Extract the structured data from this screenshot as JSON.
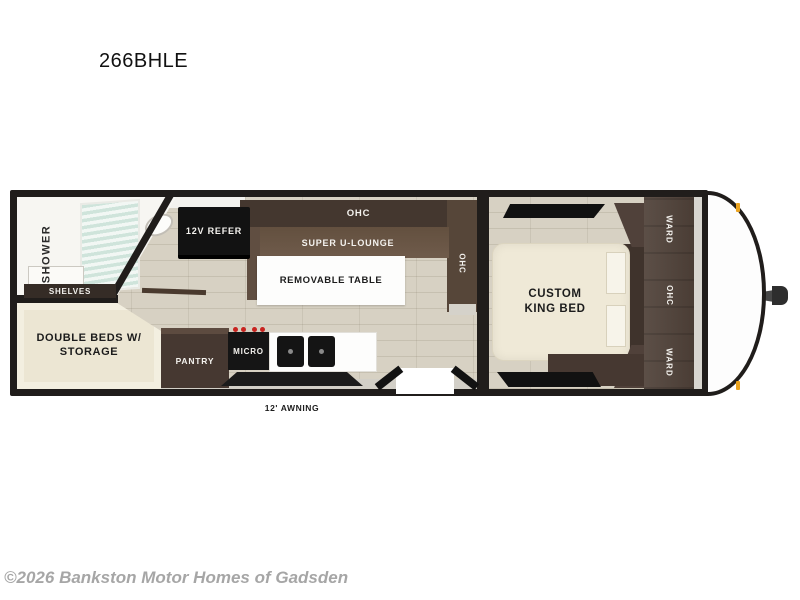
{
  "title": "266BHLE",
  "floorplan": {
    "awning": "12' AWNING",
    "bathroom": {
      "shower": "SHOWER",
      "shelves": "SHELVES"
    },
    "galley": {
      "refer": "12V REFER",
      "pantry": "PANTRY",
      "micro": "MICRO"
    },
    "living": {
      "ohc_top": "OHC",
      "lounge": "SUPER U-LOUNGE",
      "table": "REMOVABLE TABLE",
      "ohc_side": "OHC"
    },
    "bunks": {
      "line1": "DOUBLE BEDS W/",
      "line2": "STORAGE"
    },
    "bedroom": {
      "bed_line1": "CUSTOM",
      "bed_line2": "KING BED",
      "ward_top": "WARD",
      "ohc": "OHC",
      "ward_bottom": "WARD"
    }
  },
  "footer": {
    "copyright": "©2026 Bankston Motor Homes of Gadsden"
  },
  "colors": {
    "wall": "#201d1b",
    "floor": "#d7d1c3",
    "cabinet-dark": "#463831",
    "cabinet-mid": "#5c4f47",
    "lounge": "#6f5b4b",
    "cream": "#ece6d3",
    "bed-cream": "#efe9d7",
    "white": "#fdfdfc",
    "red": "#c8231f",
    "amber": "#eaa31f",
    "gray-text": "#a6a6a6",
    "ink": "#111111"
  }
}
